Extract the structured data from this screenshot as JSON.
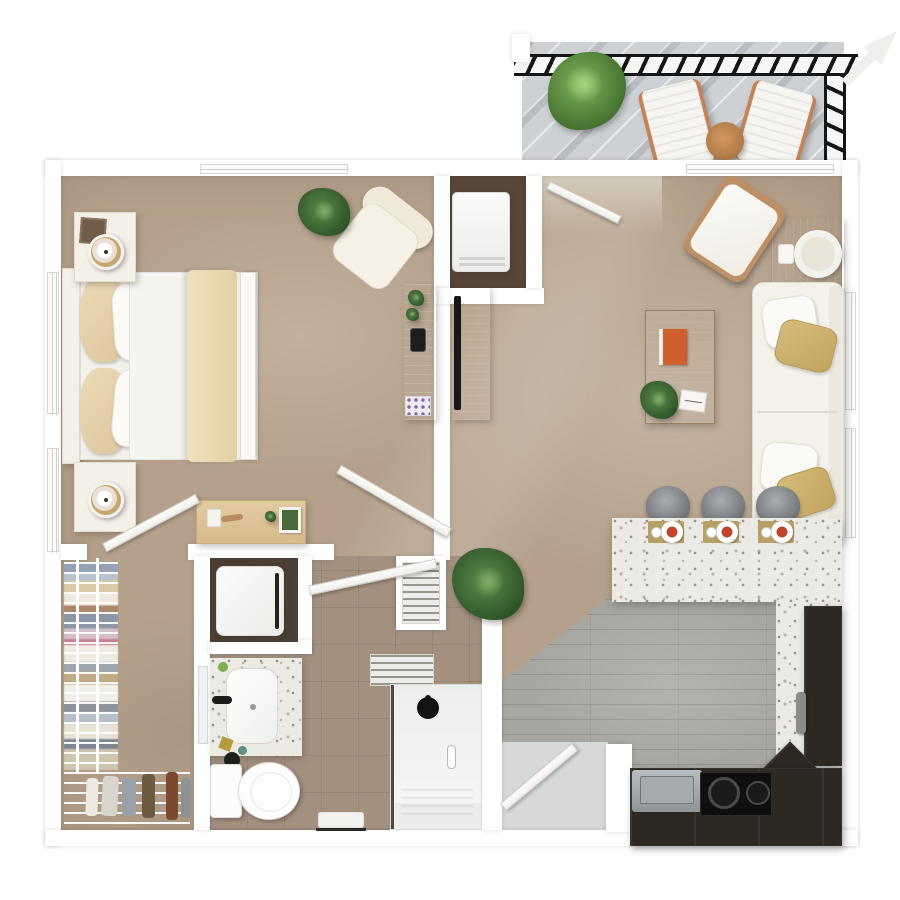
{
  "scene": {
    "title": "One Bedroom Apartment - 3D Floor Plan",
    "type": "top-down 3D architectural rendering",
    "visible_text": "none"
  },
  "palette": {
    "wall": "#ffffff",
    "carpet": "#b5a18b",
    "kitchen_wood_floor": "#a8a6a1",
    "bathroom_tile": "#a3907f",
    "balcony_deck": "#ced1d4",
    "railing": "#161616",
    "terrazzo_counter": "#eceae4",
    "dark_cabinetry": "#2e2823",
    "wood_accent": "#b98e62",
    "upholstery_cream": "#f3f0e8",
    "pillow_gold": "#cdb271",
    "greenery": "#4c7a38"
  },
  "balcony": {
    "label": "Balcony",
    "lounge_chair_count": 2,
    "items": [
      "black guard railing",
      "potted shrub",
      "two lounge chairs",
      "round wood side table",
      "direction arrow pointing top-right"
    ]
  },
  "bedroom": {
    "label": "Bedroom",
    "items": [
      "bed with cream throw",
      "headboard nightstand with lamp and photo frame",
      "second nightstand with lamp",
      "cream accent chair",
      "potted plant",
      "gray console with plants, phone and tray",
      "wood desk with decor",
      "closet door",
      "hall door",
      "two left-wall windows",
      "top-wall window"
    ]
  },
  "living_room": {
    "label": "Living Room",
    "items": [
      "entry door",
      "utility niche with white appliance",
      "white accent chair with wood frame",
      "square wood side table with round tray",
      "cream loveseat with 2 white and 2 gold pillows",
      "wood coffee table with orange book, plant, notepad",
      "media console with TV",
      "two windows behind sofa",
      "sliding window on top wall"
    ]
  },
  "kitchen": {
    "label": "Kitchen",
    "stool_count": 3,
    "place_setting_count": 3,
    "burner_count": 2,
    "items": [
      "terrazzo breakfast bar",
      "three gray bar stools",
      "three place settings on gold mats",
      "black cooktop with two burners",
      "stainless sink",
      "dark refrigerator column with gray handle",
      "L-shaped dark cabinetry",
      "corner floor plant",
      "gray plank flooring"
    ]
  },
  "bathroom": {
    "label": "Bathroom",
    "items": [
      "washer-dryer closet",
      "louvered linen closet",
      "terrazzo vanity with white sink and black faucet",
      "wall mirror",
      "toilet",
      "walk-in glass shower with black rain head",
      "louvered window",
      "bath mat with towel bar",
      "entry door",
      "swing door to shower hall"
    ]
  },
  "closet": {
    "label": "Walk-in Closet",
    "items": [
      "wire shelving with hanging clothes",
      "bottom shoe rack with boots and shoes"
    ],
    "clothes_colors": [
      "#93a2b4",
      "#d9c9a6",
      "#efe9df",
      "#a8876a",
      "#8b97a6",
      "#d4bfc8",
      "#c77f94",
      "#9fa6ad",
      "#c2ab84",
      "#7e8894"
    ]
  },
  "hall": {
    "label": "Hall"
  },
  "entry": {
    "label": "Entry"
  }
}
